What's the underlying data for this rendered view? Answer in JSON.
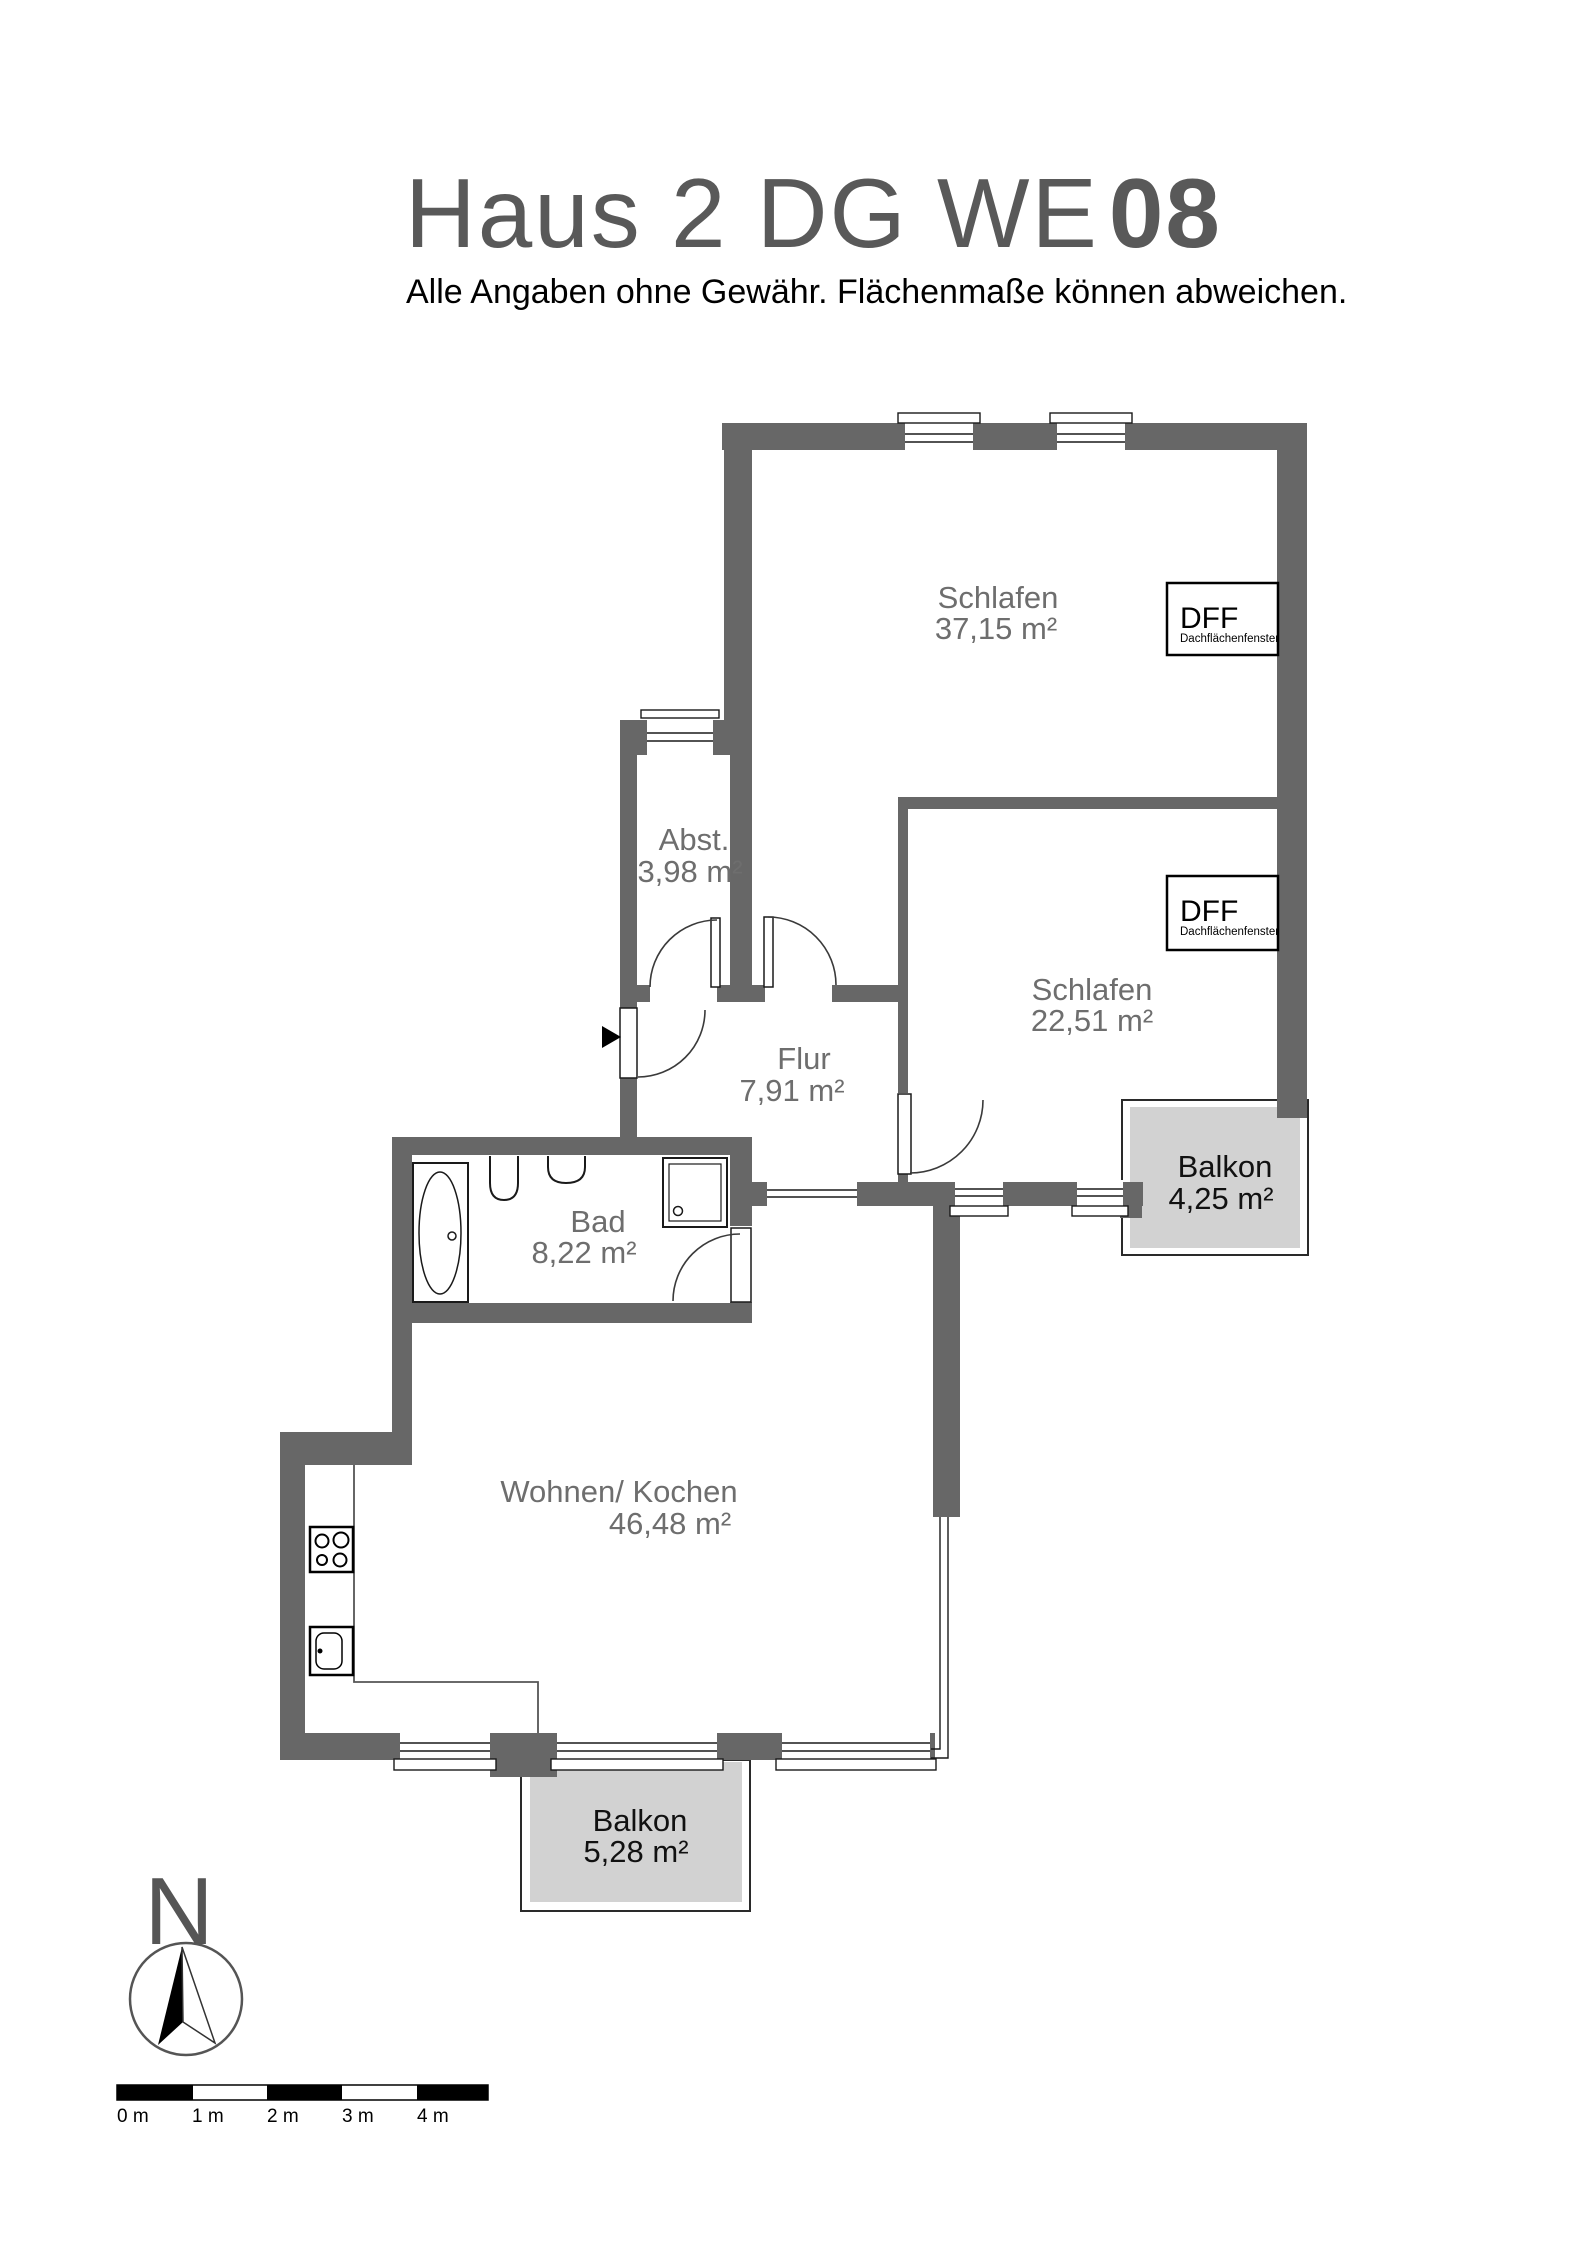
{
  "header": {
    "title_main": "Haus 2 DG WE",
    "title_number": "08",
    "subtitle": "Alle Angaben ohne Gewähr. Flächenmaße können abweichen."
  },
  "rooms": {
    "schlafen1": {
      "name": "Schlafen",
      "area": "37,15 m²"
    },
    "schlafen2": {
      "name": "Schlafen",
      "area": "22,51 m²"
    },
    "abstellraum": {
      "name": "Abst.",
      "area": "3,98 m²"
    },
    "flur": {
      "name": "Flur",
      "area": "7,91 m²"
    },
    "bad": {
      "name": "Bad",
      "area": "8,22 m²"
    },
    "wohnen_kochen": {
      "name": "Wohnen/ Kochen",
      "area": "46,48 m²"
    },
    "balkon_ost": {
      "name": "Balkon",
      "area": "4,25 m²"
    },
    "balkon_sued": {
      "name": "Balkon",
      "area": "5,28 m²"
    }
  },
  "skylight": {
    "abbr": "DFF",
    "full": "Dachflächenfenster"
  },
  "compass": {
    "north_label": "N"
  },
  "scale_bar": {
    "labels": [
      "0 m",
      "1 m",
      "2 m",
      "3 m",
      "4 m"
    ]
  },
  "colors": {
    "wall": "#676767",
    "balcony_fill": "#d2d2d2",
    "room_label": "#6e6e6e",
    "title": "#595959",
    "line": "#1a1a1a"
  }
}
